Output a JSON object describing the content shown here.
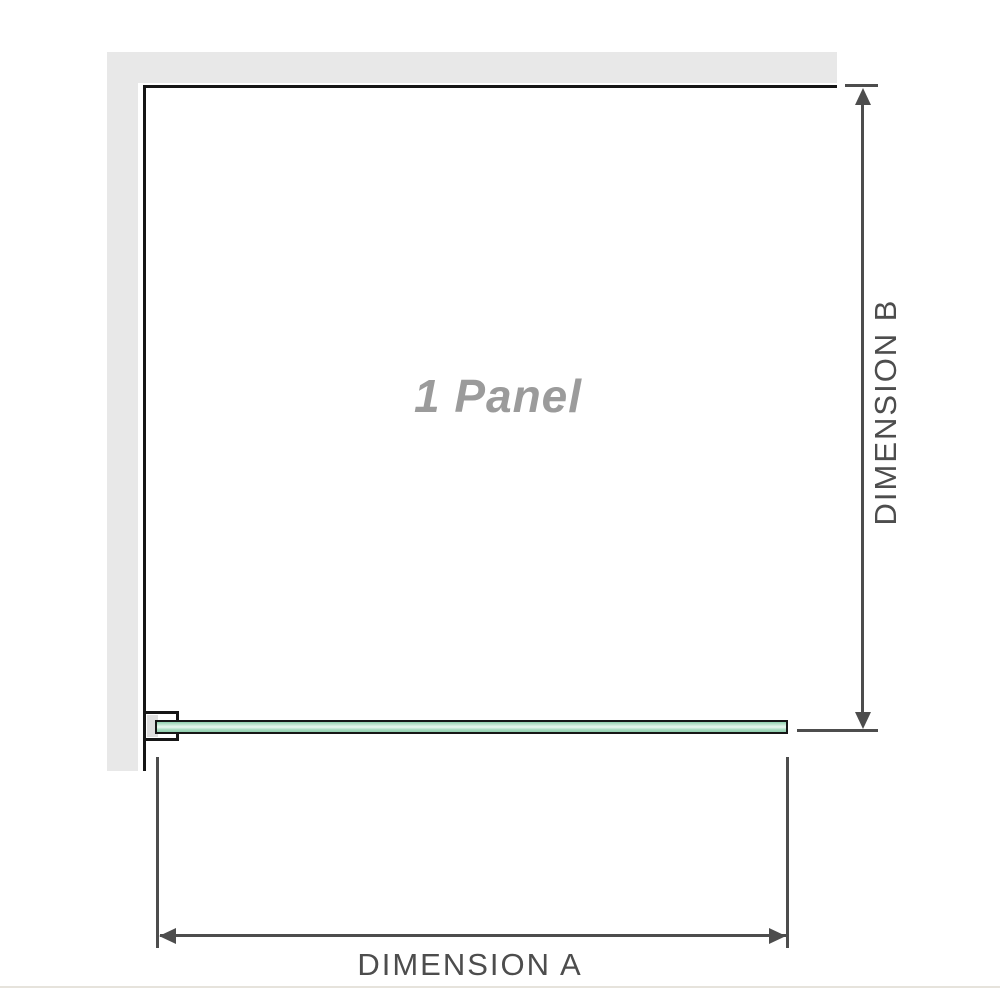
{
  "labels": {
    "panel": "1 Panel",
    "dimension_a": "DIMENSION A",
    "dimension_b": "DIMENSION B"
  },
  "colors": {
    "wall": "#e8e8e8",
    "outline": "#161616",
    "dimension": "#4d4d4d",
    "panel-label": "#9b9b9b",
    "glass-edge": "#8fcfae",
    "glass-highlight": "#eaf8f0",
    "baseline": "#e6e3dc"
  }
}
